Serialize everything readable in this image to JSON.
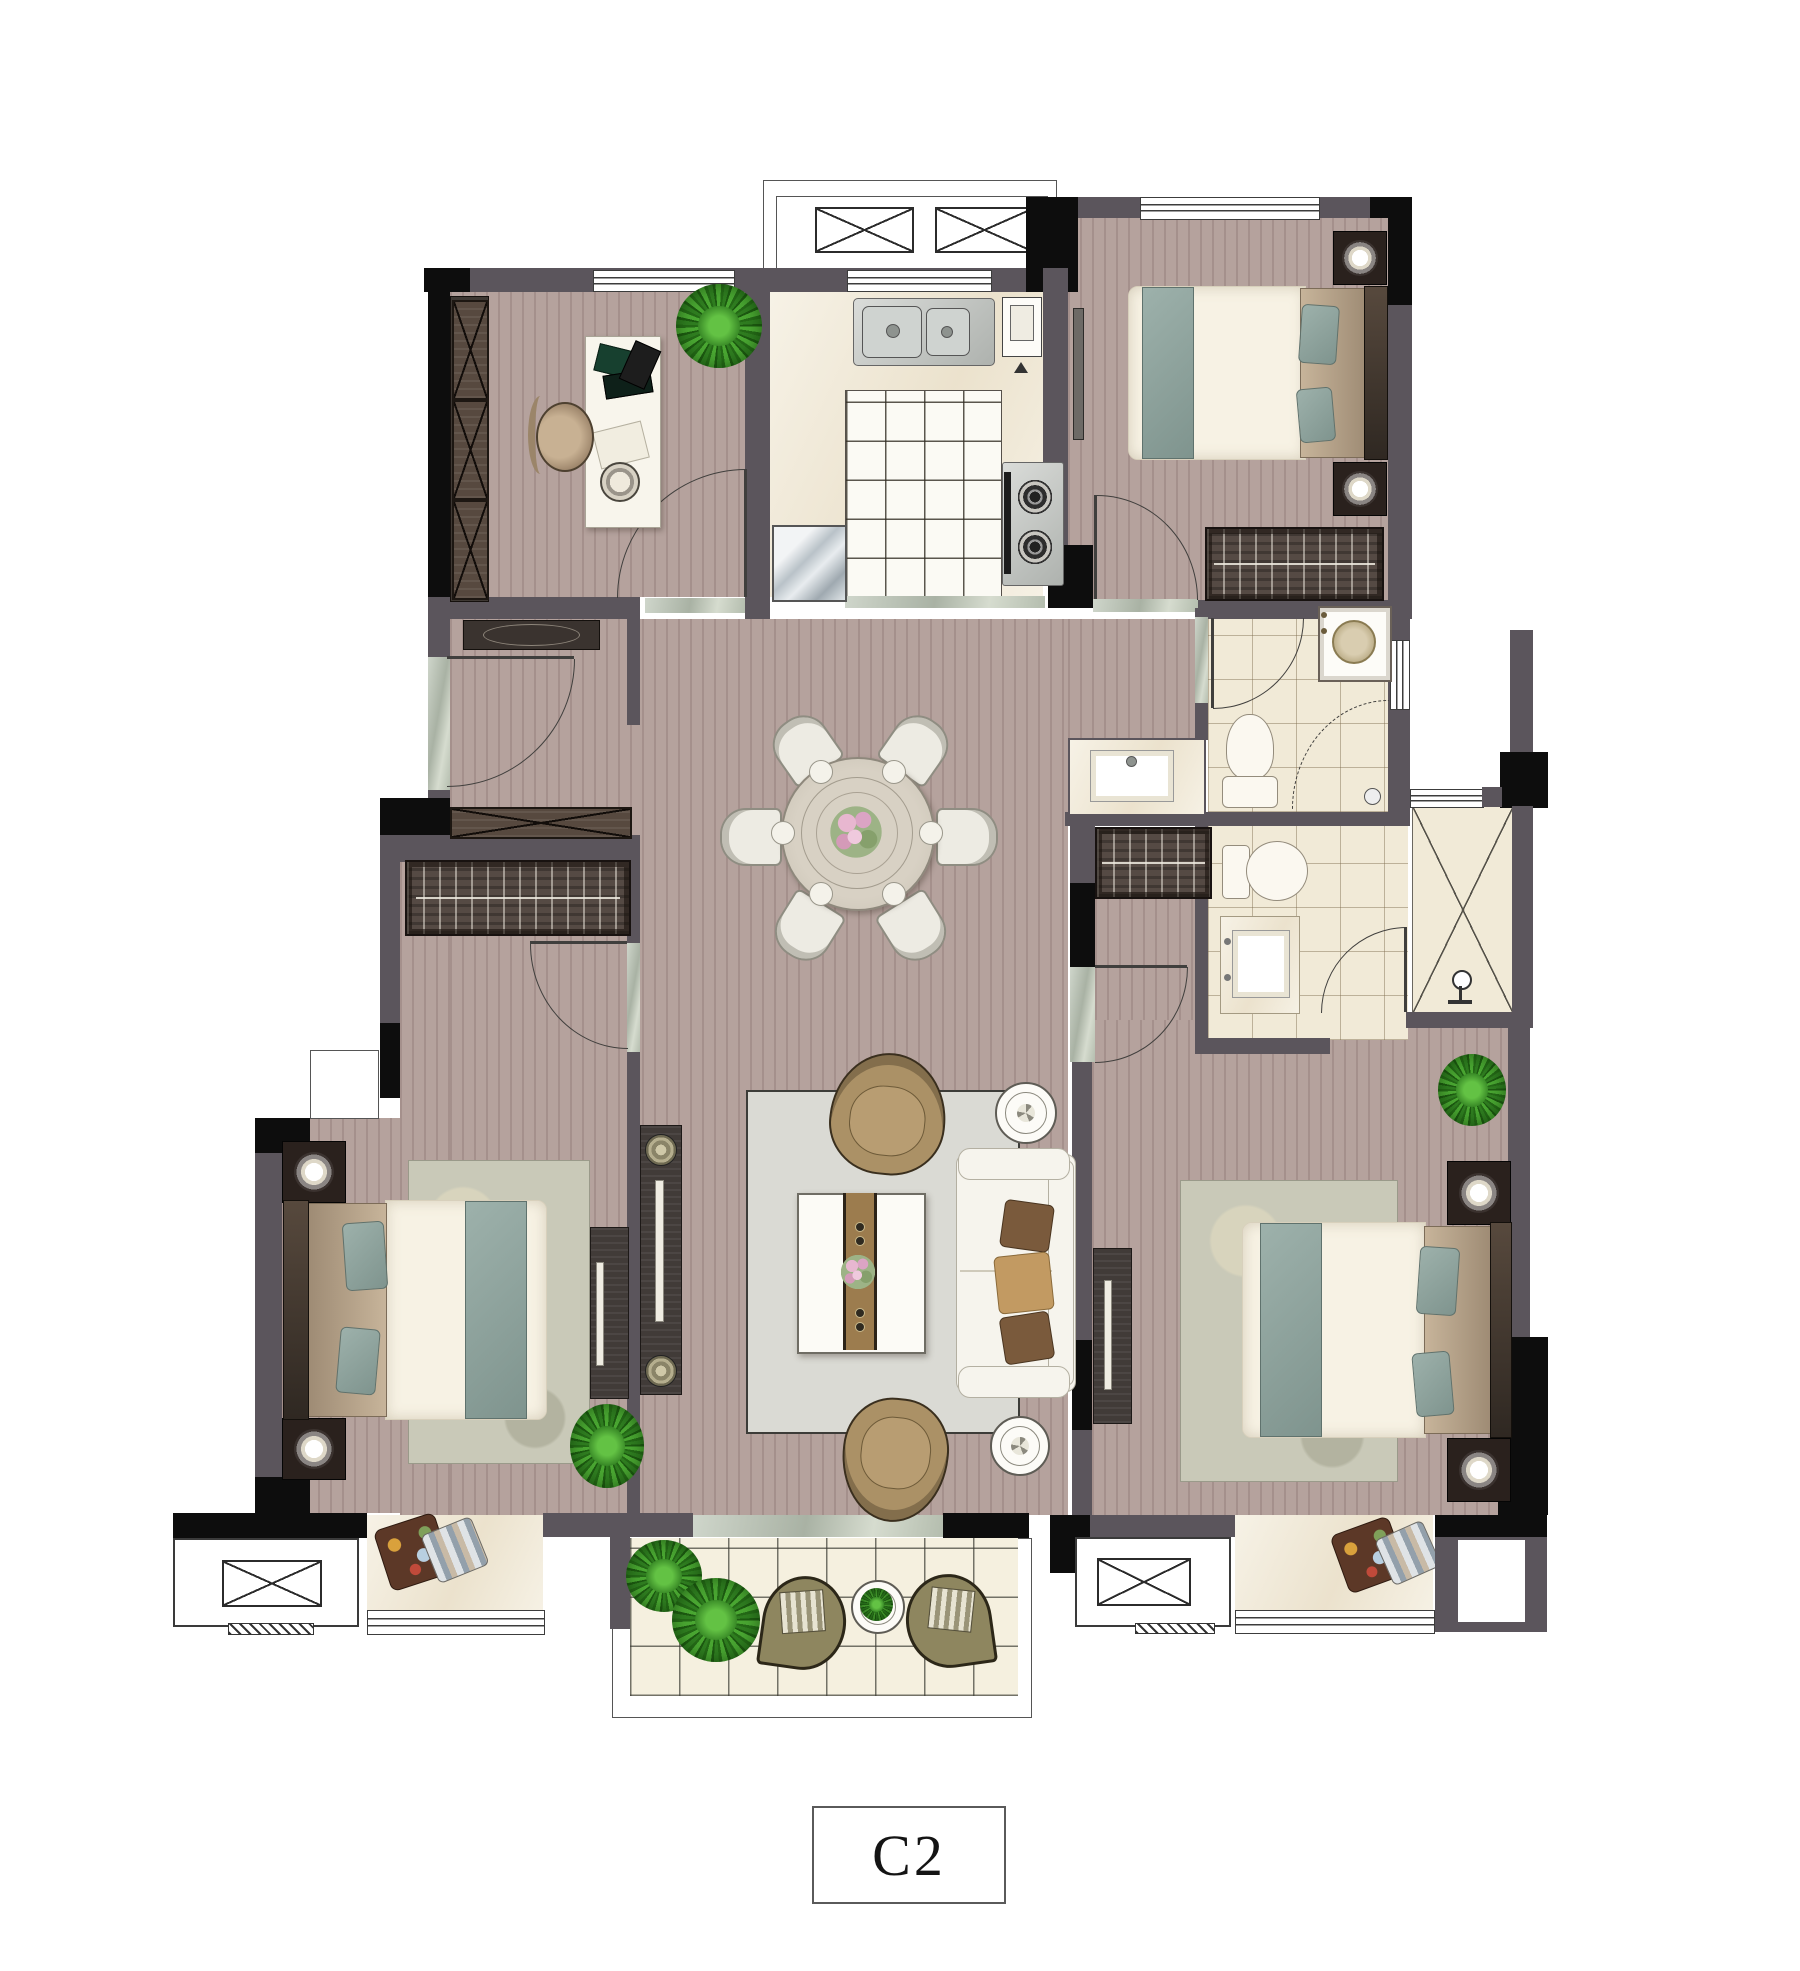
{
  "plan": {
    "label": "C2"
  },
  "colors": {
    "wall": "#5b555c",
    "structural_column": "#0d0d0d",
    "wood_floor": "#b5a29d",
    "tile_cream": "#f2ebd9",
    "tile_white": "#fbfaf4",
    "balcony_tile": "#f5f0df",
    "marble_threshold": "#b4bdae",
    "rug_sage": "#c9c9b8",
    "rug_gray": "#dadad4",
    "accent_teal": "#8aa09b",
    "furniture_dark_wood": "#413b38",
    "armchair_tan": "#ab9166",
    "sofa_white": "#f6f4ed",
    "plant_green": "#2f7d20"
  },
  "icons": {
    "equipment-platform-icon": "crossed-box",
    "wardrobe-hanger-icon": "striped-bar-with-rail",
    "door-swing-icon": "quarter-arc",
    "shower-icon": "circle-with-stem",
    "floor-drain-icon": "small-circle",
    "gas-burner-icon": "concentric-rings",
    "table-lamp-icon": "glowing-circle",
    "window-icon": "triple-line-bar"
  }
}
